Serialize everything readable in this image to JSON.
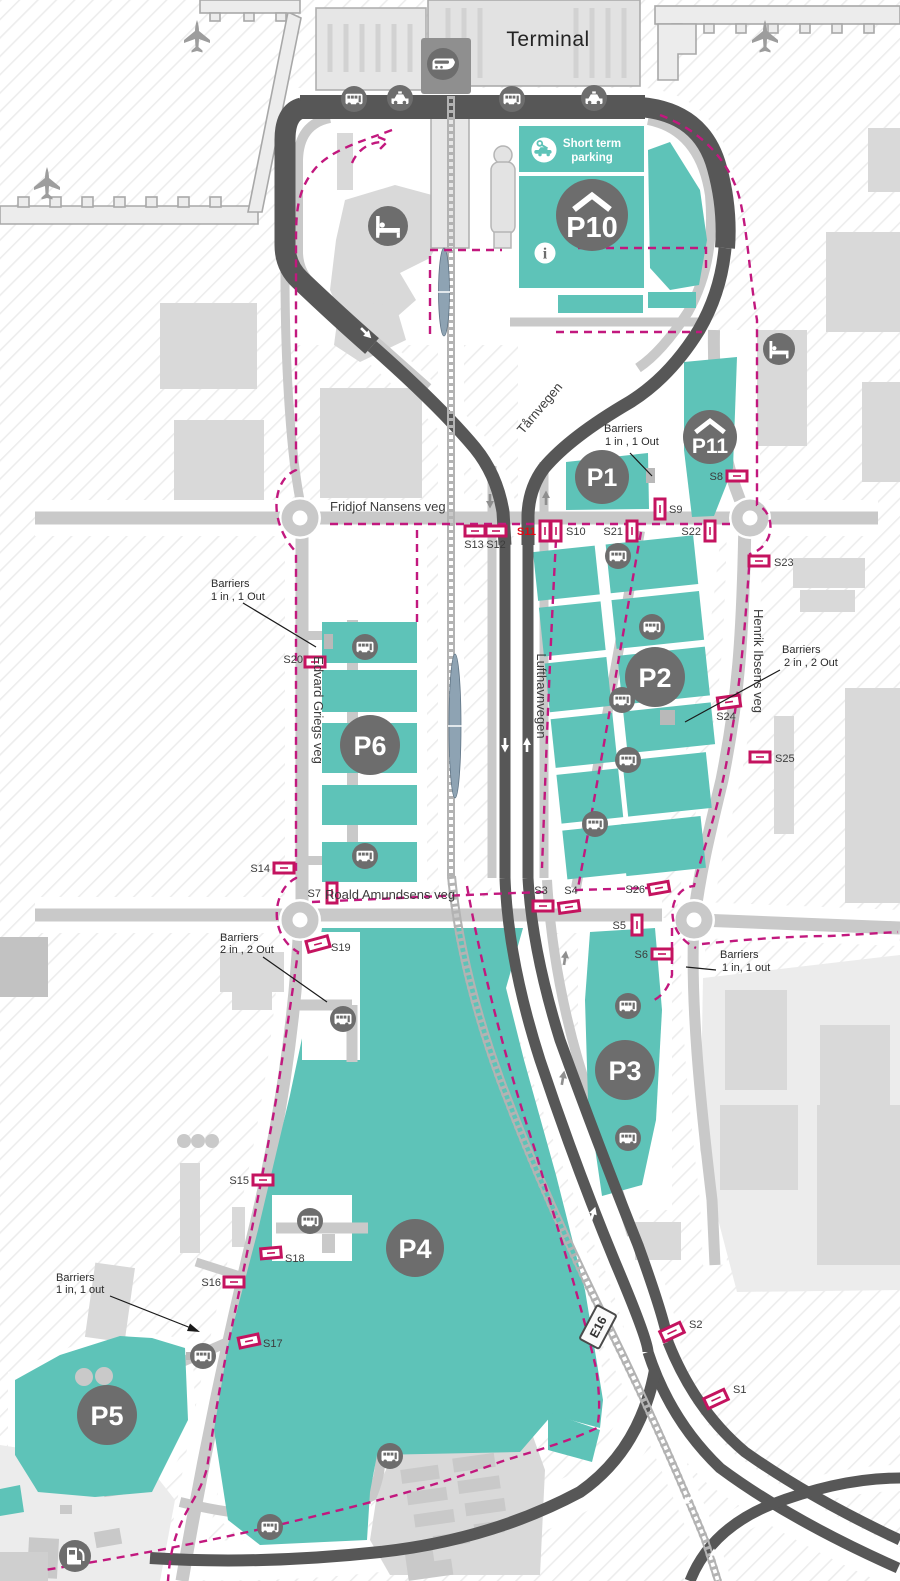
{
  "terminal": {
    "label": "Terminal"
  },
  "short_term_parking": {
    "line1": "Short term",
    "line2": "parking"
  },
  "parking": {
    "p1": "P1",
    "p2": "P2",
    "p3": "P3",
    "p4": "P4",
    "p5": "P5",
    "p6": "P6",
    "p10": "P10",
    "p11": "P11"
  },
  "roads": {
    "fridjof_nansens_veg": "Fridjof Nansens veg",
    "roald_amundsens_veg": "Roald Amundsens veg",
    "edvard_griegs_veg": "Edvard Griegs veg",
    "henrik_ibsens_veg": "Henrik Ibsens veg",
    "lufthavnvegen": "Lufthavnvegen",
    "tarnvegen": "Tårnvegen",
    "e16": "E16"
  },
  "sensors": {
    "s1": "S1",
    "s2": "S2",
    "s3": "S3",
    "s4": "S4",
    "s5": "S5",
    "s6": "S6",
    "s7": "S7",
    "s8": "S8",
    "s9": "S9",
    "s10": "S10",
    "s11": "S11",
    "s12": "S12",
    "s13": "S13",
    "s14": "S14",
    "s15": "S15",
    "s16": "S16",
    "s17": "S17",
    "s18": "S18",
    "s19": "S19",
    "s20": "S20",
    "s21": "S21",
    "s22": "S22",
    "s23": "S23",
    "s24": "S24",
    "s25": "S25",
    "s26": "S26"
  },
  "barrier_notes": {
    "p1": {
      "line1": "Barriers",
      "line2": "1 in ,  1 Out"
    },
    "p6": {
      "line1": "Barriers",
      "line2": "1 in ,  1 Out"
    },
    "p2": {
      "line1": "Barriers",
      "line2": "2 in ,  2 Out"
    },
    "p4": {
      "line1": "Barriers",
      "line2": "2 in ,  2 Out"
    },
    "p3": {
      "line1": "Barriers",
      "line2": "1 in, 1 out"
    },
    "p5": {
      "line1": "Barriers",
      "line2": "1 in, 1 out"
    }
  },
  "icons": {
    "train": "train-icon",
    "bus": "bus-icon",
    "taxi": "taxi-icon",
    "hotel": "hotel-bed-icon",
    "airplane": "airplane-icon",
    "info": "info-icon",
    "short_term_parking": "car-key-icon",
    "fuel": "fuel-pump-icon",
    "parking_garage_roof": "garage-roof-icon"
  },
  "colors": {
    "parking_area": "#5ec3b8",
    "parking_badge": "#6d6d6d",
    "road_dark": "#575757",
    "road_light": "#c9c9c9",
    "building": "#d9d9d9",
    "boundary_dashed": "#c2187e",
    "sensor_outline": "#c4135f",
    "sensor_alert_text": "#e30613",
    "railway_platform": "#8ea3b3"
  }
}
